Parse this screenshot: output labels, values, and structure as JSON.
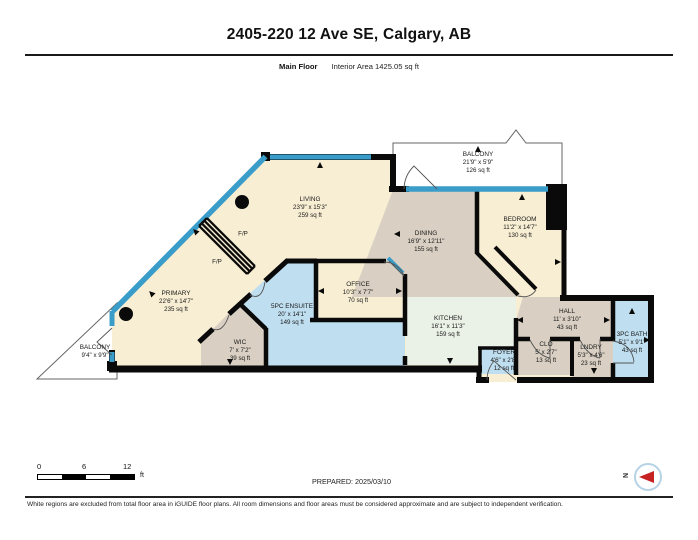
{
  "header": {
    "title": "2405-220 12 Ave SE, Calgary, AB",
    "floor_label": "Main Floor",
    "area_label": "Interior Area 1425.05 sq ft"
  },
  "floorplan": {
    "colors": {
      "room": "#f8eed3",
      "gray": "#d9d0c3",
      "wet": "#bfdff0",
      "kitchen": "#eaf1e6",
      "window": "#3a9cc9",
      "wall": "#0a0a0a"
    },
    "rooms": [
      {
        "id": "living",
        "name": "LIVING",
        "dims": "23'9\" x 15'3\"",
        "area": "259 sq ft",
        "x": 310,
        "y": 208
      },
      {
        "id": "balcony-main",
        "name": "BALCONY",
        "dims": "21'9\" x 5'9\"",
        "area": "126 sq ft",
        "x": 478,
        "y": 163
      },
      {
        "id": "bedroom",
        "name": "BEDROOM",
        "dims": "11'2\" x 14'7\"",
        "area": "130 sq ft",
        "x": 520,
        "y": 228
      },
      {
        "id": "dining",
        "name": "DINING",
        "dims": "16'9\" x 12'11\"",
        "area": "155 sq ft",
        "x": 426,
        "y": 242
      },
      {
        "id": "primary",
        "name": "PRIMARY",
        "dims": "22'6\" x 14'7\"",
        "area": "235 sq ft",
        "x": 176,
        "y": 302
      },
      {
        "id": "ensuite",
        "name": "5PC ENSUITE",
        "dims": "20' x 14'1\"",
        "area": "149 sq ft",
        "x": 292,
        "y": 315
      },
      {
        "id": "office",
        "name": "OFFICE",
        "dims": "10'3\" x 7'7\"",
        "area": "70 sq ft",
        "x": 358,
        "y": 293
      },
      {
        "id": "wic",
        "name": "WIC",
        "dims": "7' x 7'2\"",
        "area": "39 sq ft",
        "x": 240,
        "y": 351
      },
      {
        "id": "kitchen",
        "name": "KITCHEN",
        "dims": "16'1\" x 11'3\"",
        "area": "159 sq ft",
        "x": 448,
        "y": 327
      },
      {
        "id": "hall",
        "name": "HALL",
        "dims": "11' x 3'10\"",
        "area": "43 sq ft",
        "x": 567,
        "y": 320
      },
      {
        "id": "foyer",
        "name": "FOYER",
        "dims": "4'6\" x 2'8\"",
        "area": "12 sq ft",
        "x": 504,
        "y": 361
      },
      {
        "id": "clo",
        "name": "CLO",
        "dims": "5' x 2'7\"",
        "area": "13 sq ft",
        "x": 546,
        "y": 353
      },
      {
        "id": "lndry",
        "name": "LNDRY",
        "dims": "5'3\" x 4'6\"",
        "area": "23 sq ft",
        "x": 591,
        "y": 356
      },
      {
        "id": "bath",
        "name": "3PC BATH",
        "dims": "5'1\" x 9'1\"",
        "area": "43 sq ft",
        "x": 632,
        "y": 343
      },
      {
        "id": "balcony-small",
        "name": "BALCONY",
        "dims": "9'4\" x 9'9\"",
        "area": "",
        "x": 95,
        "y": 352
      }
    ],
    "features": [
      {
        "id": "fireplace-1",
        "label": "F/P",
        "x": 243,
        "y": 234
      },
      {
        "id": "fireplace-2",
        "label": "F/P",
        "x": 217,
        "y": 262
      }
    ]
  },
  "scale_bar": {
    "tick_start": "0",
    "tick_mid": "6",
    "tick_end": "12",
    "unit": "ft"
  },
  "prepared_label": "PREPARED: 2025/03/10",
  "compass_letter": "N",
  "footer_note": "White regions are excluded from total floor area in iGUIDE floor plans. All room dimensions and floor areas must be considered approximate and are subject to independent verification."
}
